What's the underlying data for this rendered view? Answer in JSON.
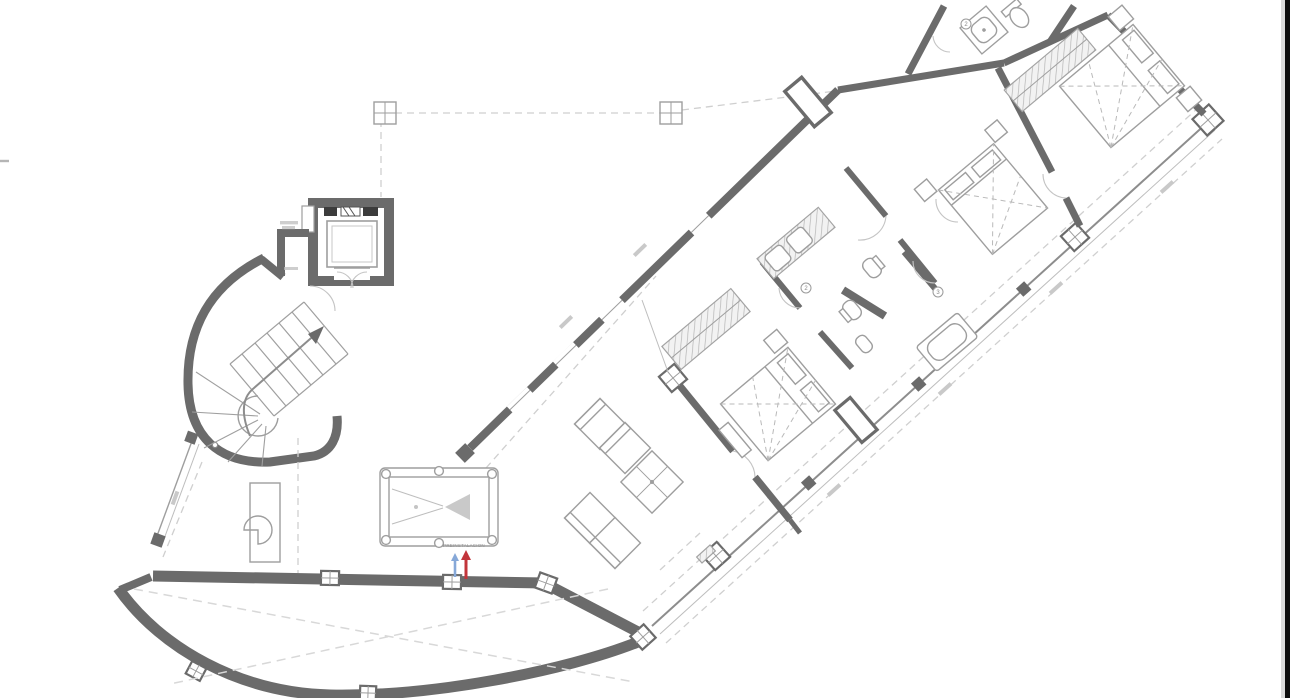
{
  "window": {
    "width": 1290,
    "height": 698,
    "background": "#ffffff"
  },
  "scan_artifacts": {
    "right_edge_dark_strip": "#0c0c0c",
    "right_edge_light_strip": "#dadada",
    "left_edge_tick_color": "#b5b5b5"
  },
  "drawing": {
    "kind": "architectural floor plan (CAD linework, gray on white)",
    "subject": "villa upper floor, wing rotated diagonally",
    "wall_color": "#6b6b6b",
    "thin_line_color": "#9e9e9e",
    "dashed_line_color": "#cfcfcf",
    "labels": {
      "preinstall": "PREINSTALACION",
      "marker_bath_left": "2",
      "marker_bath_right": "3",
      "marker_top_bath": "2"
    },
    "arrows": {
      "cold_color": "#86a8d8",
      "hot_color": "#c2353b"
    },
    "rooms": [
      {
        "name": "stair-elevator-core",
        "features": [
          "curved staircase",
          "elevator cabin",
          "machine blocks"
        ]
      },
      {
        "name": "games-living-room",
        "furniture": [
          "billiard table with pockets and rack triangle",
          "desk",
          "chair"
        ]
      },
      {
        "name": "lounge",
        "furniture": [
          "four modular sofa seats",
          "square coffee table with cross top"
        ]
      },
      {
        "name": "bedroom-1",
        "furniture": [
          "double bed",
          "wardrobe (hatched)",
          "nightstands",
          "bench"
        ]
      },
      {
        "name": "bathroom-1",
        "fixtures": [
          "double washbasin counter",
          "toilet"
        ]
      },
      {
        "name": "bathroom-2",
        "fixtures": [
          "toilet",
          "bidet"
        ]
      },
      {
        "name": "bathroom-3",
        "fixtures": [
          "bathtub"
        ]
      },
      {
        "name": "bedroom-2",
        "furniture": [
          "double bed",
          "wardrobe (hatched)",
          "nightstands"
        ]
      },
      {
        "name": "top-bathroom",
        "fixtures": [
          "shower tray",
          "washbasin"
        ]
      },
      {
        "name": "bedroom-3",
        "furniture": [
          "double bed",
          "wardrobe (hatched)",
          "nightstands"
        ]
      },
      {
        "name": "curved-terrace",
        "features": [
          "thick curved parapet",
          "window posts",
          "dashed cross bracing"
        ]
      }
    ],
    "notes": "tiny dimension annotations along facades are illegible at source resolution (rendered as gray ticks)"
  }
}
